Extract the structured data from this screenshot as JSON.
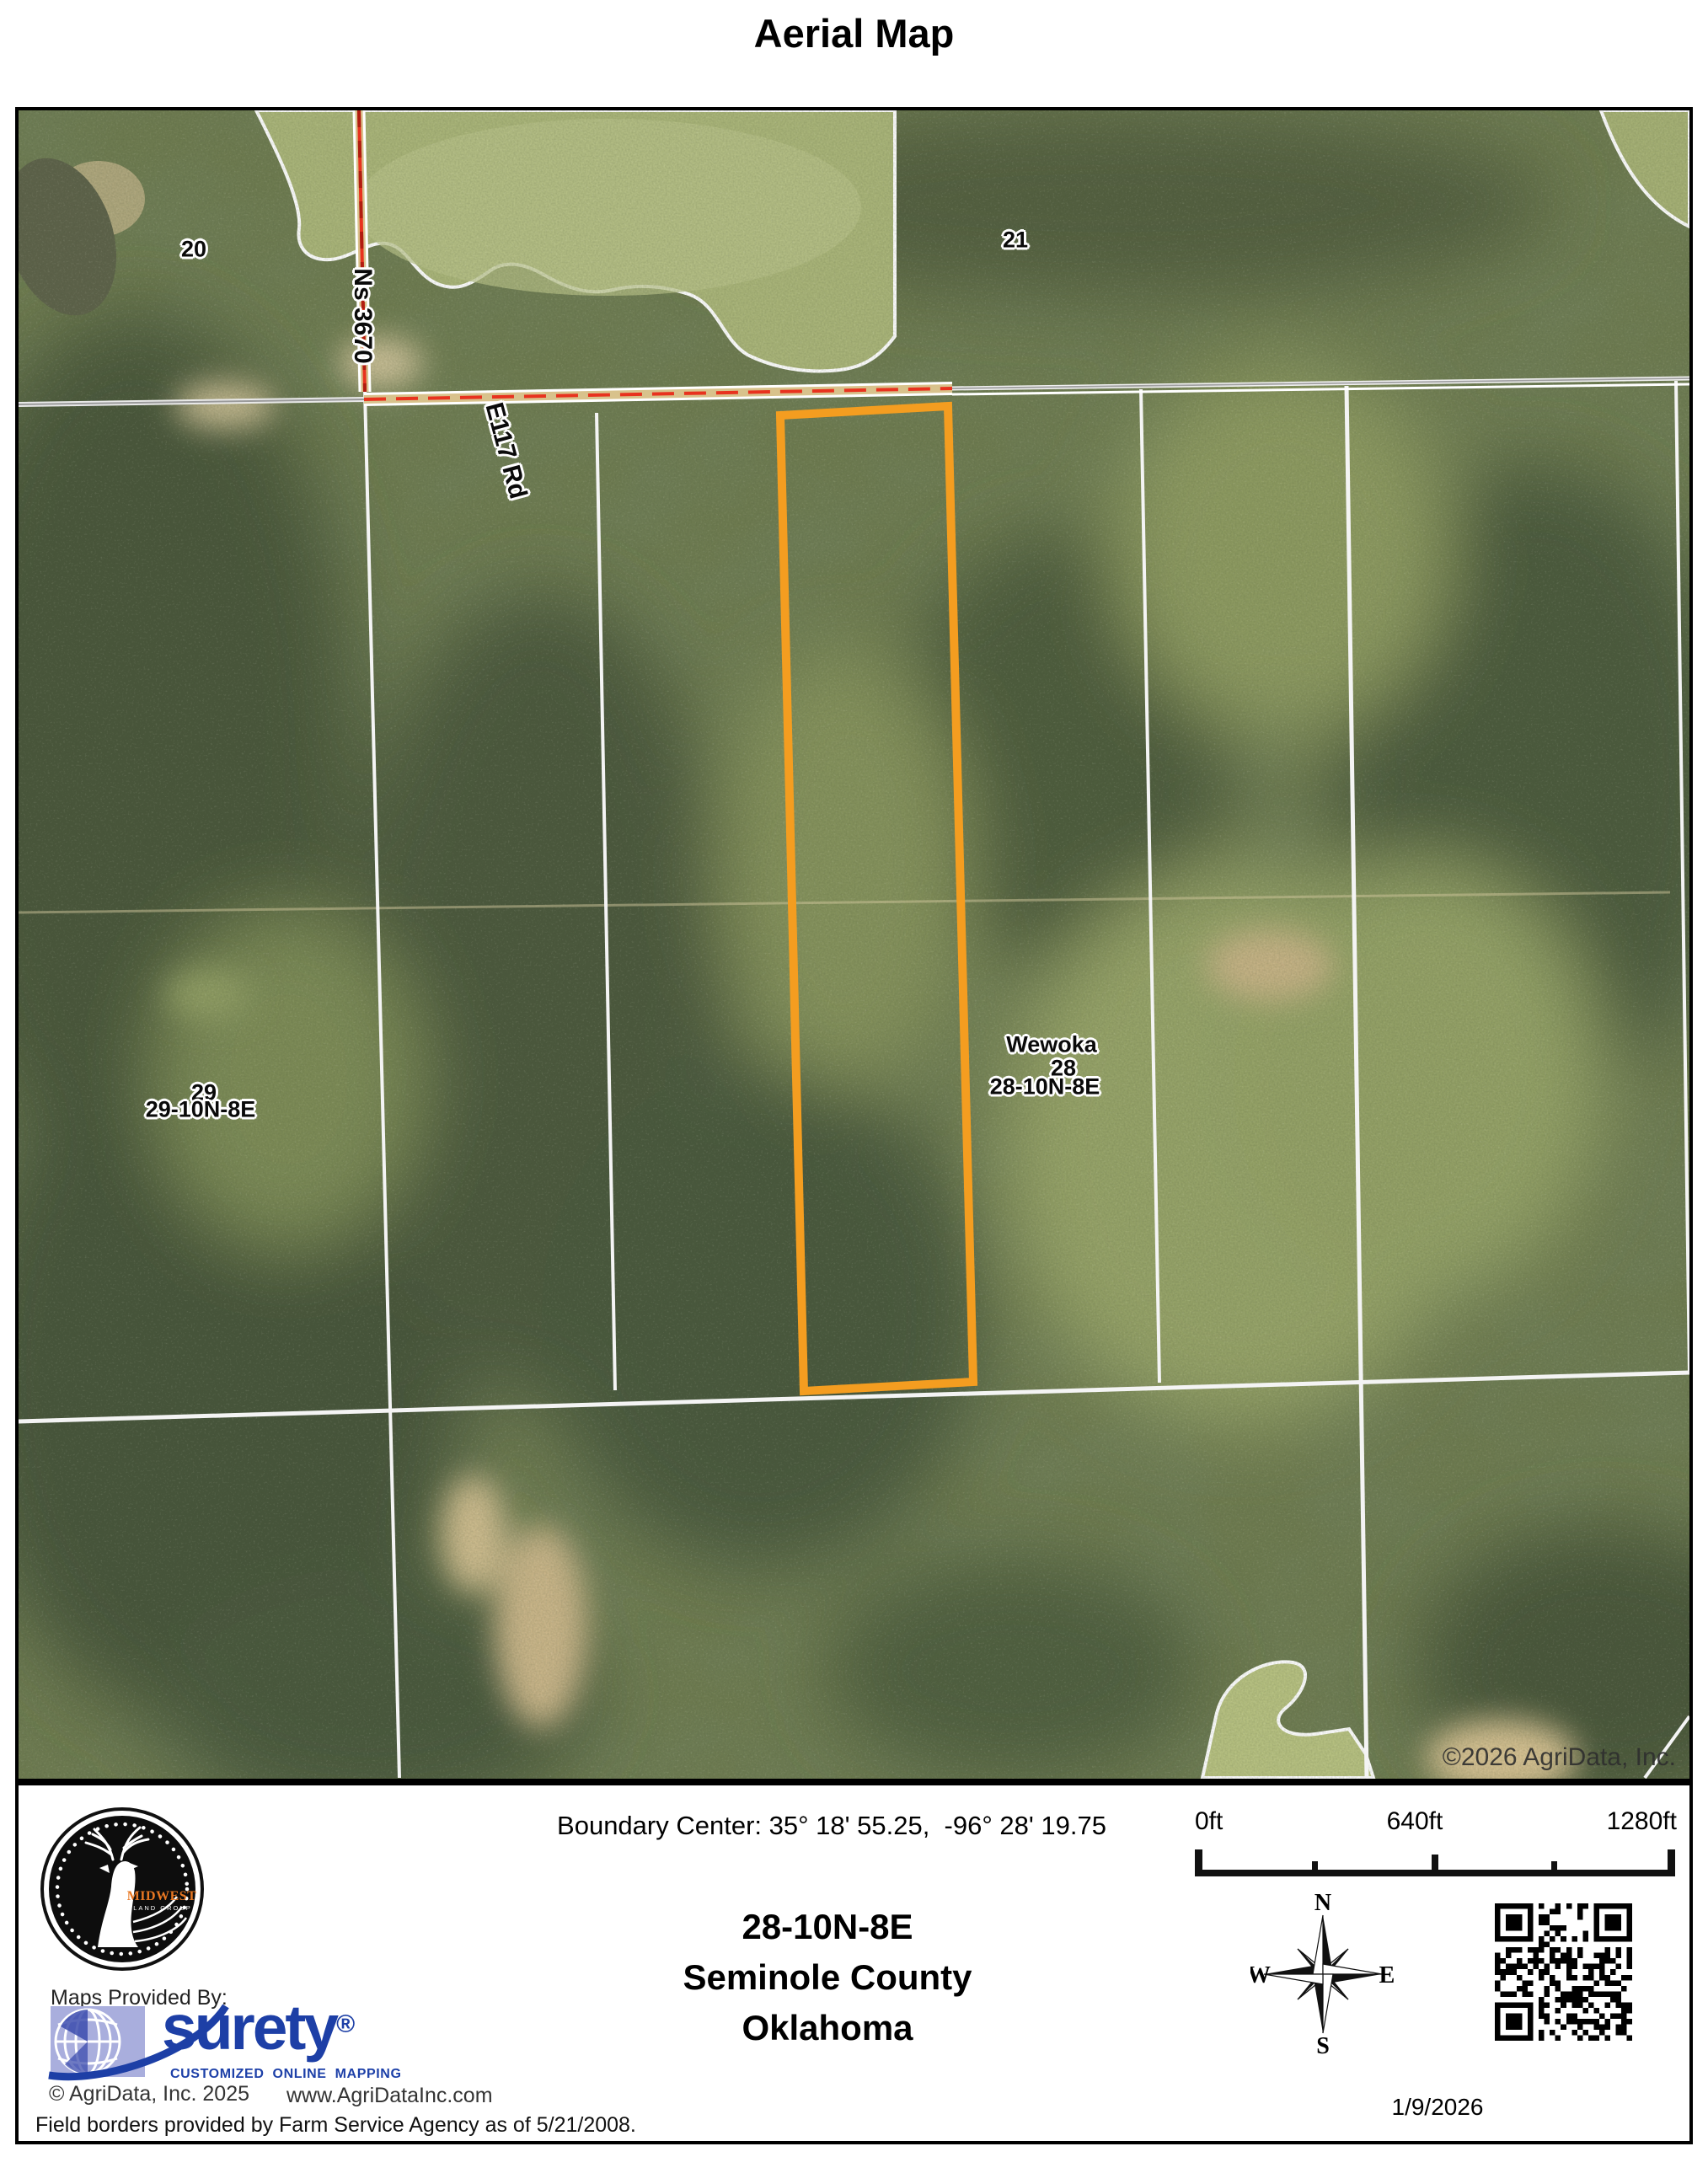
{
  "title": "Aerial Map",
  "map": {
    "labels": {
      "section_20": "20",
      "section_21": "21",
      "road_ns": "Ns 3670",
      "road_e117": "E117 Rd",
      "town": "Wewoka",
      "section_28_hidden": "28",
      "trs_28": "28-10N-8E",
      "section_29_hidden": "29",
      "trs_29": "29-10N-8E",
      "copyright": "©2026 AgriData, Inc."
    },
    "parcel_outline_color": "#F49D20"
  },
  "panel": {
    "boundary_center": "Boundary Center: 35° 18' 55.25,  -96° 28' 19.75",
    "location": {
      "trs": "28-10N-8E",
      "county": "Seminole County",
      "state": "Oklahoma"
    },
    "scale": {
      "tick0": "0ft",
      "tick1": "640ft",
      "tick2": "1280ft"
    },
    "compass": {
      "n": "N",
      "s": "S",
      "e": "E",
      "w": "W"
    },
    "date": "1/9/2026",
    "maps_provided_by": "Maps Provided By:",
    "midwest_logo": {
      "name": "MIDWEST",
      "sub": "LAND GROUP",
      "accent_color": "#e87722"
    },
    "surety": {
      "name": "surety",
      "registered": "®",
      "tagline": "CUSTOMIZED ONLINE MAPPING",
      "brand_color": "#1d3fa6"
    },
    "agridata_copyright": "© AgriData, Inc. 2025",
    "agridata_url": "www.AgriDataInc.com",
    "field_borders_note": "Field borders provided by Farm Service Agency as of 5/21/2008."
  }
}
